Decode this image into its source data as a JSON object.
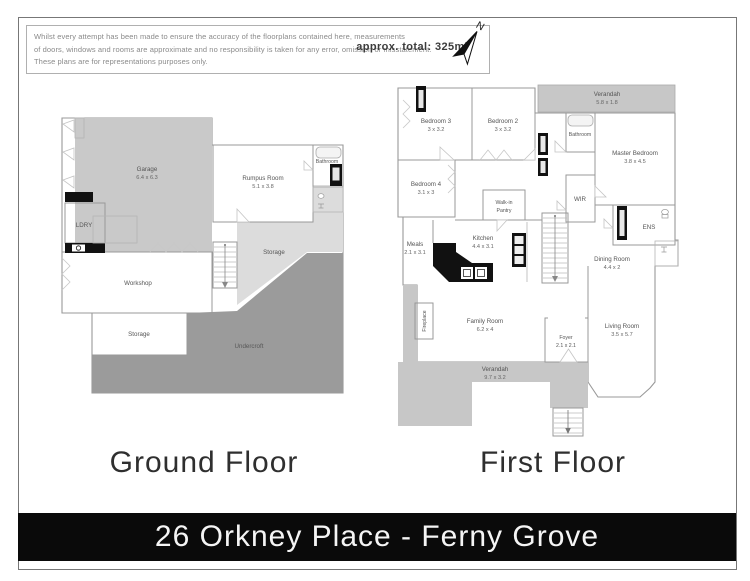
{
  "header": {
    "disclaimer_lines": [
      "Whilst every attempt has been made to ensure the accuracy of the floorplans contained here, measurements",
      "of doors, windows and rooms are approximate and no responsibility is taken for any error, omission or misstatement.",
      "These plans are for representations purposes only."
    ],
    "approx_total": "approx. total: 325m²",
    "north_label": "N"
  },
  "ground_floor": {
    "title": "Ground Floor",
    "rooms": {
      "garage": {
        "name": "Garage",
        "dims": "6.4 x 6.3"
      },
      "rumpus": {
        "name": "Rumpus Room",
        "dims": "5.1 x 3.8"
      },
      "bathroom": {
        "name": "Bathroom"
      },
      "laundry": {
        "name": "LDRY"
      },
      "storage_upper": {
        "name": "Storage"
      },
      "workshop": {
        "name": "Workshop"
      },
      "storage_lower": {
        "name": "Storage"
      },
      "undercroft": {
        "name": "Undercroft"
      }
    }
  },
  "first_floor": {
    "title": "First Floor",
    "rooms": {
      "verandah_top": {
        "name": "Verandah",
        "dims": "5.8 x 1.8"
      },
      "bedroom3": {
        "name": "Bedroom 3",
        "dims": "3 x 3.2"
      },
      "bedroom2": {
        "name": "Bedroom 2",
        "dims": "3 x 3.2"
      },
      "bathroom": {
        "name": "Bathroom"
      },
      "master_bedroom": {
        "name": "Master Bedroom",
        "dims": "3.8 x 4.5"
      },
      "bedroom4": {
        "name": "Bedroom 4",
        "dims": "3.1 x 3"
      },
      "walk_in_pantry": {
        "line1": "Walk-in",
        "line2": "Pantry"
      },
      "wir": {
        "name": "WIR"
      },
      "meals": {
        "name": "Meals",
        "dims": "2.1 x 3.1"
      },
      "kitchen": {
        "name": "Kitchen",
        "dims": "4.4 x 3.1"
      },
      "ens": {
        "name": "ENS"
      },
      "dining": {
        "name": "Dining Room",
        "dims": "4.4 x 2"
      },
      "fireplace": {
        "name": "Fireplace"
      },
      "family": {
        "name": "Family Room",
        "dims": "6.2 x 4"
      },
      "foyer": {
        "name": "Foyer",
        "dims": "2.1 x 2.1"
      },
      "living": {
        "name": "Living Room",
        "dims": "3.5 x 5.7"
      },
      "verandah_bottom": {
        "name": "Verandah",
        "dims": "9.7 x 3.2"
      }
    }
  },
  "footer": {
    "title": "26 Orkney Place - Ferny Grove"
  },
  "colors": {
    "garage_fill": "#c9c9c9",
    "verandah_fill": "#c7c7c7",
    "storage_fill": "#dcdcdc",
    "undercroft_fill": "#9b9b9b",
    "accent_black": "#111111",
    "footer_bg": "#0a0a0a"
  }
}
